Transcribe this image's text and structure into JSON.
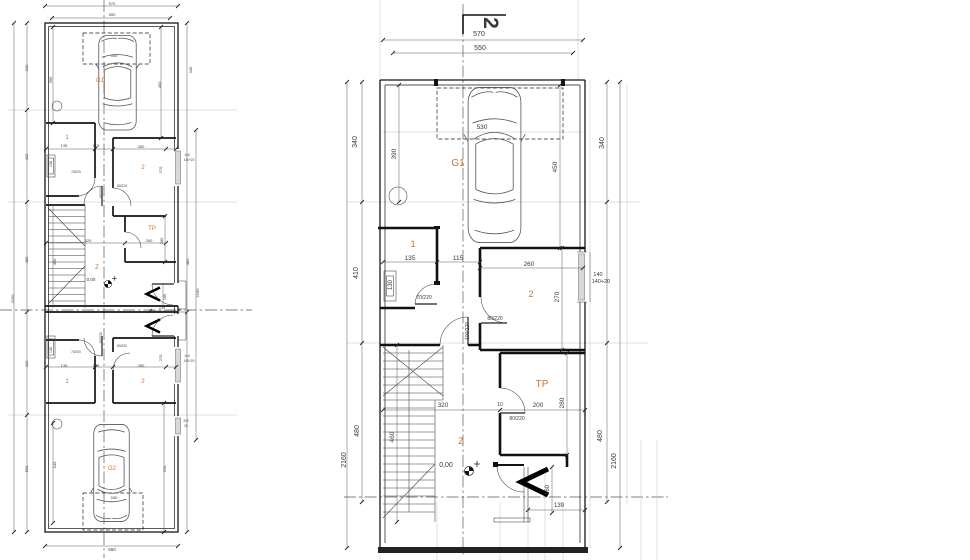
{
  "meta": {
    "title": "floor-plan-drawing",
    "background": "#ffffff",
    "accent": "#cf722e",
    "line_color": "#1a1a1a"
  },
  "plans": {
    "left": {
      "description": "overall-plan-two-units",
      "labels": [
        {
          "n": "dim-570",
          "t": "570",
          "x": 112,
          "y": 5,
          "s": 4
        },
        {
          "n": "dim-550-top",
          "t": "550",
          "x": 112,
          "y": 16,
          "s": 4
        },
        {
          "n": "dim-530-a",
          "t": "530",
          "x": 114,
          "y": 57,
          "s": 4
        },
        {
          "n": "room-garage-a",
          "t": "G1",
          "x": 100,
          "y": 82,
          "s": 6,
          "c": "a"
        },
        {
          "n": "dim-340-left",
          "t": "340",
          "x": 28,
          "y": 68,
          "r": 1,
          "s": 4
        },
        {
          "n": "dim-390",
          "t": "390",
          "x": 52,
          "y": 80,
          "r": 1,
          "s": 4
        },
        {
          "n": "dim-450",
          "t": "450",
          "x": 161,
          "y": 85,
          "r": 1,
          "s": 4
        },
        {
          "n": "dim-340-right",
          "t": "340",
          "x": 192,
          "y": 70,
          "r": 1,
          "s": 4
        },
        {
          "n": "room-1a",
          "t": "1",
          "x": 67,
          "y": 139,
          "s": 6,
          "c": "a"
        },
        {
          "n": "dim-135-a",
          "t": "135",
          "x": 64,
          "y": 147,
          "s": 4
        },
        {
          "n": "dim-115-a",
          "t": "115",
          "x": 96,
          "y": 147,
          "s": 4
        },
        {
          "n": "dim-260-a",
          "t": "260",
          "x": 141,
          "y": 148,
          "s": 4
        },
        {
          "n": "room-2a",
          "t": "2",
          "x": 143,
          "y": 169,
          "s": 6,
          "c": "a"
        },
        {
          "n": "dim-270-a",
          "t": "270",
          "x": 162,
          "y": 170,
          "r": 1,
          "s": 4
        },
        {
          "n": "dim-130-a",
          "t": "130",
          "x": 52,
          "y": 164,
          "r": 1,
          "s": 3.8
        },
        {
          "n": "door-70-220-a",
          "t": "70/220",
          "x": 76,
          "y": 173,
          "s": 3.2
        },
        {
          "n": "door-80-220-a",
          "t": "80/220",
          "x": 122,
          "y": 187,
          "s": 3.2
        },
        {
          "n": "door-100-220-a",
          "t": "100/220",
          "x": 102,
          "y": 193,
          "r": 1,
          "s": 3.2
        },
        {
          "n": "win-140-a",
          "t": "140",
          "x": 187,
          "y": 156,
          "s": 3.2
        },
        {
          "n": "win-140-20-a",
          "t": "140+20",
          "x": 189,
          "y": 161,
          "s": 3.2
        },
        {
          "n": "dim-410-left",
          "t": "410",
          "x": 28,
          "y": 157,
          "r": 1,
          "s": 4
        },
        {
          "n": "dim-480-left",
          "t": "480",
          "x": 28,
          "y": 260,
          "r": 1,
          "s": 4
        },
        {
          "n": "dim-2160-left",
          "t": "2160",
          "x": 14,
          "y": 299,
          "r": 1,
          "s": 4
        },
        {
          "n": "room-tp-a",
          "t": "TP",
          "x": 152,
          "y": 230,
          "s": 6,
          "c": "a"
        },
        {
          "n": "dim-320-a",
          "t": "320",
          "x": 88,
          "y": 242,
          "s": 4
        },
        {
          "n": "dim-200-a",
          "t": "200",
          "x": 149,
          "y": 242,
          "s": 4
        },
        {
          "n": "dim-280-a",
          "t": "280",
          "x": 163,
          "y": 241,
          "r": 1,
          "s": 4
        },
        {
          "n": "dim-460-a",
          "t": "460",
          "x": 56,
          "y": 262,
          "r": 1,
          "s": 4
        },
        {
          "n": "room-z-a",
          "t": "Z",
          "x": 97,
          "y": 269,
          "s": 6,
          "c": "a"
        },
        {
          "n": "level-marker-a",
          "t": "0,00",
          "x": 91,
          "y": 281,
          "s": 4.5
        },
        {
          "n": "dim-160-a",
          "t": "160",
          "x": 166,
          "y": 297,
          "r": 1,
          "s": 3.8
        },
        {
          "n": "dim-139-a",
          "t": "139",
          "x": 162,
          "y": 309,
          "s": 3.8
        },
        {
          "n": "dim-480-right",
          "t": "480",
          "x": 189,
          "y": 262,
          "r": 1,
          "s": 4
        },
        {
          "n": "dim-2160-right",
          "t": "2160",
          "x": 199,
          "y": 293,
          "r": 1,
          "s": 4
        },
        {
          "n": "door-100-220-b",
          "t": "100/220",
          "x": 102,
          "y": 338,
          "r": 1,
          "s": 3.2
        },
        {
          "n": "door-80-220-b",
          "t": "80/220",
          "x": 122,
          "y": 347,
          "s": 3.2
        },
        {
          "n": "door-70-220-b",
          "t": "70/220",
          "x": 76,
          "y": 353,
          "s": 3.2
        },
        {
          "n": "dim-130-b",
          "t": "130",
          "x": 52,
          "y": 350,
          "r": 1,
          "s": 3.8
        },
        {
          "n": "win-140-b",
          "t": "140",
          "x": 187,
          "y": 357,
          "s": 3.2
        },
        {
          "n": "win-140-20-b",
          "t": "140+20",
          "x": 189,
          "y": 362,
          "s": 3.2
        },
        {
          "n": "dim-270-b",
          "t": "270",
          "x": 162,
          "y": 358,
          "r": 1,
          "s": 4
        },
        {
          "n": "dim-135-b",
          "t": "135",
          "x": 64,
          "y": 367,
          "s": 4
        },
        {
          "n": "dim-115-b",
          "t": "115",
          "x": 96,
          "y": 367,
          "s": 4
        },
        {
          "n": "dim-260-b",
          "t": "260",
          "x": 141,
          "y": 367,
          "s": 4
        },
        {
          "n": "room-1b",
          "t": "1",
          "x": 67,
          "y": 383,
          "s": 6,
          "c": "a"
        },
        {
          "n": "room-2b",
          "t": "2",
          "x": 143,
          "y": 383,
          "s": 6,
          "c": "a"
        },
        {
          "n": "dim-410-left-b",
          "t": "410",
          "x": 28,
          "y": 364,
          "r": 1,
          "s": 4
        },
        {
          "n": "dim-550-left-b",
          "t": "550",
          "x": 28,
          "y": 469,
          "r": 1,
          "s": 4
        },
        {
          "n": "win-200-b",
          "t": "200",
          "x": 186,
          "y": 422,
          "s": 3.2
        },
        {
          "n": "win-20-b",
          "t": "20",
          "x": 186,
          "y": 427,
          "s": 3.2
        },
        {
          "n": "room-garage-b",
          "t": "G2",
          "x": 112,
          "y": 470,
          "s": 6,
          "c": "a"
        },
        {
          "n": "dim-540-b",
          "t": "540",
          "x": 56,
          "y": 465,
          "r": 1,
          "s": 4
        },
        {
          "n": "dim-550-right-b",
          "t": "550",
          "x": 166,
          "y": 469,
          "r": 1,
          "s": 4
        },
        {
          "n": "dim-530-b",
          "t": "530",
          "x": 114,
          "y": 499,
          "s": 4
        },
        {
          "n": "dim-550-bottom",
          "t": "550",
          "x": 112,
          "y": 551,
          "s": 4.5
        }
      ]
    },
    "right": {
      "description": "enlarged-unit-plan",
      "labels": [
        {
          "n": "section-marker-2",
          "t": "2",
          "x": 484,
          "y": 23,
          "r": 2,
          "s": 21,
          "b": 1
        },
        {
          "n": "dim-570",
          "t": "570",
          "x": 479,
          "y": 36,
          "s": 7
        },
        {
          "n": "dim-550",
          "t": "550",
          "x": 480,
          "y": 50,
          "s": 7
        },
        {
          "n": "dim-530",
          "t": "530",
          "x": 482,
          "y": 129,
          "s": 6.5
        },
        {
          "n": "room-garage",
          "t": "G1",
          "x": 458,
          "y": 166,
          "s": 10,
          "c": "a"
        },
        {
          "n": "dim-340-left",
          "t": "340",
          "x": 357,
          "y": 142,
          "r": 1,
          "s": 7
        },
        {
          "n": "dim-390",
          "t": "390",
          "x": 396,
          "y": 154,
          "r": 1,
          "s": 6.5
        },
        {
          "n": "dim-450",
          "t": "450",
          "x": 557,
          "y": 167,
          "r": 1,
          "s": 6.5
        },
        {
          "n": "dim-340-right",
          "t": "340",
          "x": 604,
          "y": 143,
          "r": 1,
          "s": 7
        },
        {
          "n": "room-1",
          "t": "1",
          "x": 413,
          "y": 247,
          "s": 9,
          "c": "a"
        },
        {
          "n": "dim-135",
          "t": "135",
          "x": 410,
          "y": 260,
          "s": 6.5
        },
        {
          "n": "dim-115",
          "t": "115",
          "x": 458,
          "y": 260,
          "s": 6.5
        },
        {
          "n": "dim-260",
          "t": "260",
          "x": 529,
          "y": 266,
          "s": 6.5
        },
        {
          "n": "room-2",
          "t": "2",
          "x": 531,
          "y": 297,
          "s": 9,
          "c": "a"
        },
        {
          "n": "dim-270",
          "t": "270",
          "x": 559,
          "y": 297,
          "r": 1,
          "s": 6.5
        },
        {
          "n": "dim-130",
          "t": "130",
          "x": 392,
          "y": 285,
          "r": 1,
          "s": 6
        },
        {
          "n": "door-70-220",
          "t": "70/220",
          "x": 424,
          "y": 299,
          "s": 5
        },
        {
          "n": "door-80-220",
          "t": "80/220",
          "x": 495,
          "y": 320,
          "s": 5
        },
        {
          "n": "door-100-220",
          "t": "100/220",
          "x": 469,
          "y": 331,
          "r": 1,
          "s": 5
        },
        {
          "n": "win-140",
          "t": "140",
          "x": 598,
          "y": 276,
          "s": 5.5
        },
        {
          "n": "win-140-20",
          "t": "140+20",
          "x": 601,
          "y": 283,
          "s": 5.5
        },
        {
          "n": "dim-410-left",
          "t": "410",
          "x": 358,
          "y": 273,
          "r": 1,
          "s": 7
        },
        {
          "n": "dim-480-left",
          "t": "480",
          "x": 359,
          "y": 431,
          "r": 1,
          "s": 7
        },
        {
          "n": "dim-2160-left",
          "t": "2160",
          "x": 346,
          "y": 460,
          "r": 1,
          "s": 7
        },
        {
          "n": "room-tp",
          "t": "TP",
          "x": 542,
          "y": 387,
          "s": 10,
          "c": "a"
        },
        {
          "n": "dim-320",
          "t": "320",
          "x": 443,
          "y": 407,
          "s": 6.5
        },
        {
          "n": "dim-10",
          "t": "10",
          "x": 500,
          "y": 406,
          "s": 5
        },
        {
          "n": "dim-200",
          "t": "200",
          "x": 538,
          "y": 407,
          "s": 6.5
        },
        {
          "n": "dim-280",
          "t": "280",
          "x": 564,
          "y": 403,
          "r": 1,
          "s": 6.5
        },
        {
          "n": "door-80-220-tp",
          "t": "80/220",
          "x": 517,
          "y": 420,
          "s": 5
        },
        {
          "n": "dim-460",
          "t": "460",
          "x": 394,
          "y": 437,
          "r": 1,
          "s": 6.5
        },
        {
          "n": "room-z",
          "t": "Z",
          "x": 461,
          "y": 444,
          "s": 9,
          "c": "a"
        },
        {
          "n": "level-marker",
          "t": "0,00",
          "x": 446,
          "y": 467,
          "s": 7
        },
        {
          "n": "dim-480-right",
          "t": "480",
          "x": 602,
          "y": 436,
          "r": 1,
          "s": 7
        },
        {
          "n": "dim-2160-right",
          "t": "2160",
          "x": 616,
          "y": 461,
          "r": 1,
          "s": 7
        },
        {
          "n": "dim-160",
          "t": "160",
          "x": 549,
          "y": 490,
          "r": 1,
          "s": 6
        },
        {
          "n": "dim-139",
          "t": "139",
          "x": 559,
          "y": 507,
          "s": 6
        }
      ]
    }
  }
}
